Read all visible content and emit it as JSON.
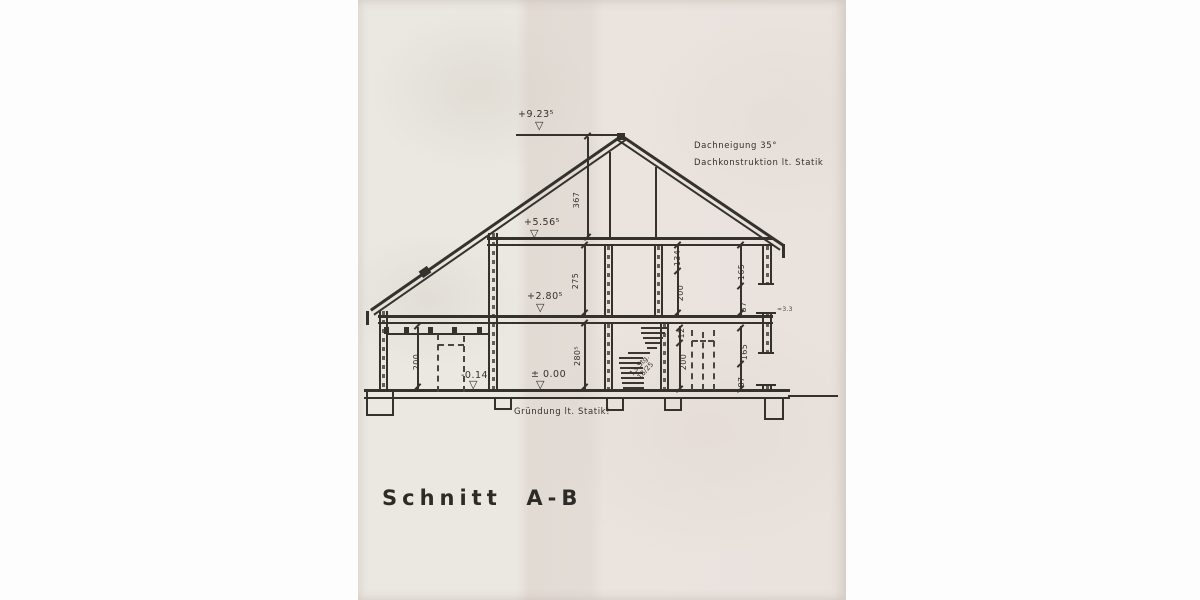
{
  "drawing": {
    "title": "Schnitt  A-B",
    "notes": {
      "roof_pitch": "Dachneigung 35°",
      "roof_construction": "Dachkonstruktion lt. Statik",
      "foundation": "Gründung lt. Statik!",
      "eaves_mark": "≈3.3"
    },
    "levels": {
      "ridge": "+9.23⁵",
      "attic_floor": "+5.56⁵",
      "upper_floor": "+2.80⁵",
      "ground_floor": "± 0.00",
      "garage_floor": "-0.14"
    },
    "marker_glyph": "▽",
    "dimensions": {
      "roof_height": "367",
      "upper_storey_height": "275",
      "ground_storey_height": "280⁵",
      "garage_door_height": "200",
      "upper_lintel": "134",
      "upper_door_height": "200",
      "ground_lintel": "12",
      "ground_door_height": "200",
      "upper_window_height": "165",
      "upper_sill_height": "87",
      "ground_window_height": "165",
      "ground_sill_height": "87"
    },
    "stairs": {
      "count": "13 Stg.",
      "rise_run": "18/25"
    }
  }
}
